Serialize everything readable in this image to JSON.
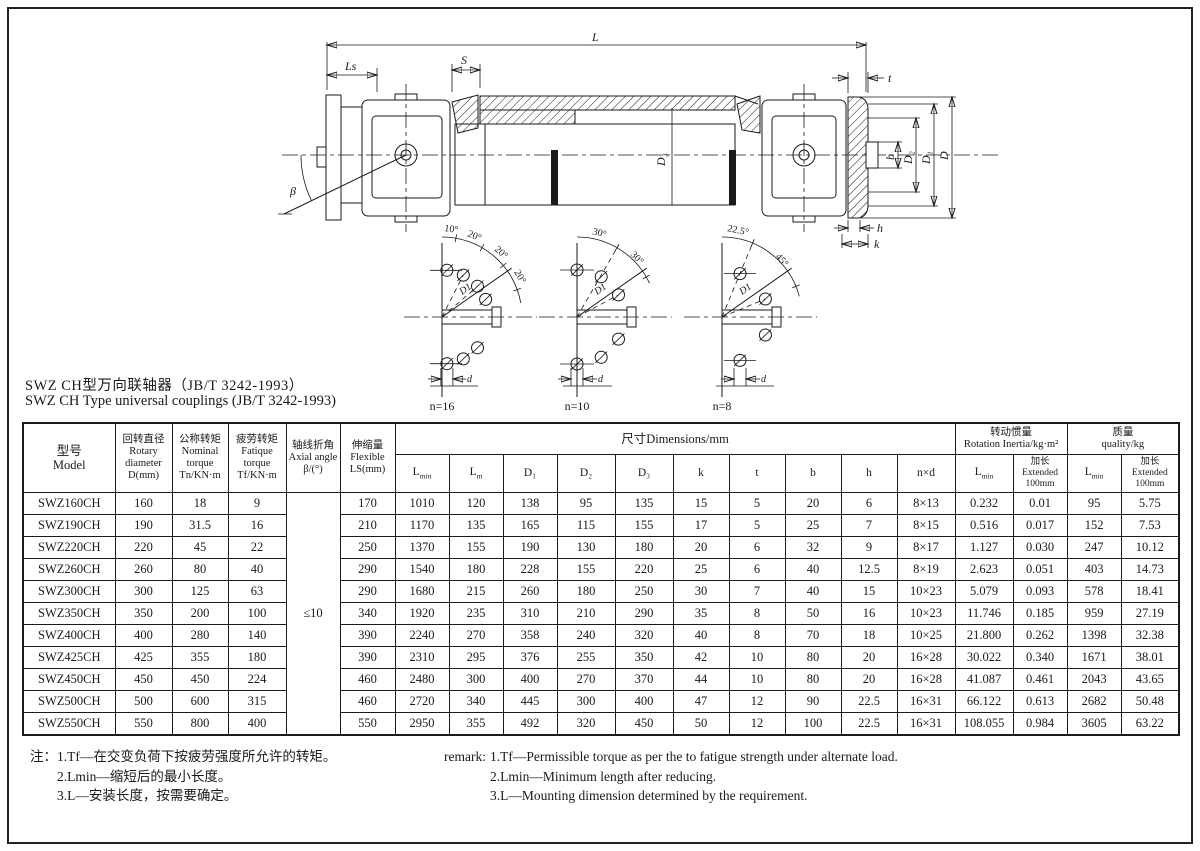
{
  "page": {
    "title_zh": "SWZ CH型万向联轴器（JB/T 3242-1993）",
    "title_en": "SWZ CH Type universal couplings (JB/T 3242-1993)"
  },
  "drawing": {
    "dims": {
      "L": "L",
      "Ls": "Ls",
      "S": "S",
      "t": "t",
      "beta": "β",
      "D": "D",
      "D1": "D₁",
      "D2": "D₂",
      "D3": "D₃",
      "b": "b",
      "h": "h",
      "k": "k"
    },
    "details": [
      {
        "n": "n=16",
        "angles": [
          "10°",
          "20°",
          "20°",
          "20°"
        ],
        "dia": "D1",
        "d": "d"
      },
      {
        "n": "n=10",
        "angles": [
          "30°",
          "30°"
        ],
        "dia": "D1",
        "d": "d"
      },
      {
        "n": "n=8",
        "angles": [
          "22.5°",
          "45°"
        ],
        "dia": "D1",
        "d": "d"
      }
    ]
  },
  "table": {
    "top_headers": {
      "model": "型号\nModel",
      "rotary": "回转直径\nRotary\ndiameter\nD(mm)",
      "nominal": "公称转矩\nNominal\ntorque\nTn/KN·m",
      "fatigue": "疲劳转矩\nFatique\ntorque\nTf/KN·m",
      "axial": "轴线折角\nAxial angle\nβ/(°)",
      "flexible": "伸缩量\nFlexible\nLS(mm)",
      "dimensions": "尺寸Dimensions/mm",
      "inertia": "转动惯量\nRotation Inertia/kg·m²",
      "mass": "质量\nquality/kg"
    },
    "sub_headers": {
      "lmin": {
        "main": "L",
        "sub": "min"
      },
      "lm": {
        "main": "L",
        "sub": "m"
      },
      "d1": "D₁",
      "d2": "D₂",
      "d3": "D₃",
      "k": "k",
      "t": "t",
      "b": "b",
      "h": "h",
      "nxd": "n×d",
      "inertia_lmin": {
        "main": "L",
        "sub": "min"
      },
      "extended": "加长\nExtended\n100mm",
      "mass_lmin": {
        "main": "L",
        "sub": "min"
      }
    },
    "beta_value": "≤10",
    "row_keys": [
      "model",
      "d",
      "tn",
      "tf",
      "ls",
      "lmin",
      "lm",
      "d1",
      "d2",
      "d3",
      "k",
      "t",
      "b",
      "h",
      "nxd",
      "inertia_lmin",
      "inertia_ext",
      "mass_lmin",
      "mass_ext"
    ],
    "rows": [
      {
        "model": "SWZ160CH",
        "d": "160",
        "tn": "18",
        "tf": "9",
        "ls": "170",
        "lmin": "1010",
        "lm": "120",
        "d1": "138",
        "d2": "95",
        "d3": "135",
        "k": "15",
        "t": "5",
        "b": "20",
        "h": "6",
        "nxd": "8×13",
        "inertia_lmin": "0.232",
        "inertia_ext": "0.01",
        "mass_lmin": "95",
        "mass_ext": "5.75"
      },
      {
        "model": "SWZ190CH",
        "d": "190",
        "tn": "31.5",
        "tf": "16",
        "ls": "210",
        "lmin": "1170",
        "lm": "135",
        "d1": "165",
        "d2": "115",
        "d3": "155",
        "k": "17",
        "t": "5",
        "b": "25",
        "h": "7",
        "nxd": "8×15",
        "inertia_lmin": "0.516",
        "inertia_ext": "0.017",
        "mass_lmin": "152",
        "mass_ext": "7.53"
      },
      {
        "model": "SWZ220CH",
        "d": "220",
        "tn": "45",
        "tf": "22",
        "ls": "250",
        "lmin": "1370",
        "lm": "155",
        "d1": "190",
        "d2": "130",
        "d3": "180",
        "k": "20",
        "t": "6",
        "b": "32",
        "h": "9",
        "nxd": "8×17",
        "inertia_lmin": "1.127",
        "inertia_ext": "0.030",
        "mass_lmin": "247",
        "mass_ext": "10.12"
      },
      {
        "model": "SWZ260CH",
        "d": "260",
        "tn": "80",
        "tf": "40",
        "ls": "290",
        "lmin": "1540",
        "lm": "180",
        "d1": "228",
        "d2": "155",
        "d3": "220",
        "k": "25",
        "t": "6",
        "b": "40",
        "h": "12.5",
        "nxd": "8×19",
        "inertia_lmin": "2.623",
        "inertia_ext": "0.051",
        "mass_lmin": "403",
        "mass_ext": "14.73"
      },
      {
        "model": "SWZ300CH",
        "d": "300",
        "tn": "125",
        "tf": "63",
        "ls": "290",
        "lmin": "1680",
        "lm": "215",
        "d1": "260",
        "d2": "180",
        "d3": "250",
        "k": "30",
        "t": "7",
        "b": "40",
        "h": "15",
        "nxd": "10×23",
        "inertia_lmin": "5.079",
        "inertia_ext": "0.093",
        "mass_lmin": "578",
        "mass_ext": "18.41"
      },
      {
        "model": "SWZ350CH",
        "d": "350",
        "tn": "200",
        "tf": "100",
        "ls": "340",
        "lmin": "1920",
        "lm": "235",
        "d1": "310",
        "d2": "210",
        "d3": "290",
        "k": "35",
        "t": "8",
        "b": "50",
        "h": "16",
        "nxd": "10×23",
        "inertia_lmin": "11.746",
        "inertia_ext": "0.185",
        "mass_lmin": "959",
        "mass_ext": "27.19"
      },
      {
        "model": "SWZ400CH",
        "d": "400",
        "tn": "280",
        "tf": "140",
        "ls": "390",
        "lmin": "2240",
        "lm": "270",
        "d1": "358",
        "d2": "240",
        "d3": "320",
        "k": "40",
        "t": "8",
        "b": "70",
        "h": "18",
        "nxd": "10×25",
        "inertia_lmin": "21.800",
        "inertia_ext": "0.262",
        "mass_lmin": "1398",
        "mass_ext": "32.38"
      },
      {
        "model": "SWZ425CH",
        "d": "425",
        "tn": "355",
        "tf": "180",
        "ls": "390",
        "lmin": "2310",
        "lm": "295",
        "d1": "376",
        "d2": "255",
        "d3": "350",
        "k": "42",
        "t": "10",
        "b": "80",
        "h": "20",
        "nxd": "16×28",
        "inertia_lmin": "30.022",
        "inertia_ext": "0.340",
        "mass_lmin": "1671",
        "mass_ext": "38.01"
      },
      {
        "model": "SWZ450CH",
        "d": "450",
        "tn": "450",
        "tf": "224",
        "ls": "460",
        "lmin": "2480",
        "lm": "300",
        "d1": "400",
        "d2": "270",
        "d3": "370",
        "k": "44",
        "t": "10",
        "b": "80",
        "h": "20",
        "nxd": "16×28",
        "inertia_lmin": "41.087",
        "inertia_ext": "0.461",
        "mass_lmin": "2043",
        "mass_ext": "43.65"
      },
      {
        "model": "SWZ500CH",
        "d": "500",
        "tn": "600",
        "tf": "315",
        "ls": "460",
        "lmin": "2720",
        "lm": "340",
        "d1": "445",
        "d2": "300",
        "d3": "400",
        "k": "47",
        "t": "12",
        "b": "90",
        "h": "22.5",
        "nxd": "16×31",
        "inertia_lmin": "66.122",
        "inertia_ext": "0.613",
        "mass_lmin": "2682",
        "mass_ext": "50.48"
      },
      {
        "model": "SWZ550CH",
        "d": "550",
        "tn": "800",
        "tf": "400",
        "ls": "550",
        "lmin": "2950",
        "lm": "355",
        "d1": "492",
        "d2": "320",
        "d3": "450",
        "k": "50",
        "t": "12",
        "b": "100",
        "h": "22.5",
        "nxd": "16×31",
        "inertia_lmin": "108.055",
        "inertia_ext": "0.984",
        "mass_lmin": "3605",
        "mass_ext": "63.22"
      }
    ]
  },
  "notes_zh": {
    "label": "注：",
    "lines": [
      "1.Tf—在交变负荷下按疲劳强度所允许的转矩。",
      "2.Lmin—缩短后的最小长度。",
      "3.L—安装长度，按需要确定。"
    ]
  },
  "notes_en": {
    "label": "remark:",
    "lines": [
      "1.Tf—Permissible torque as per the to fatigue strength under alternate load.",
      "2.Lmin—Minimum length after reducing.",
      "3.L—Mounting dimension determined by the requirement."
    ]
  }
}
